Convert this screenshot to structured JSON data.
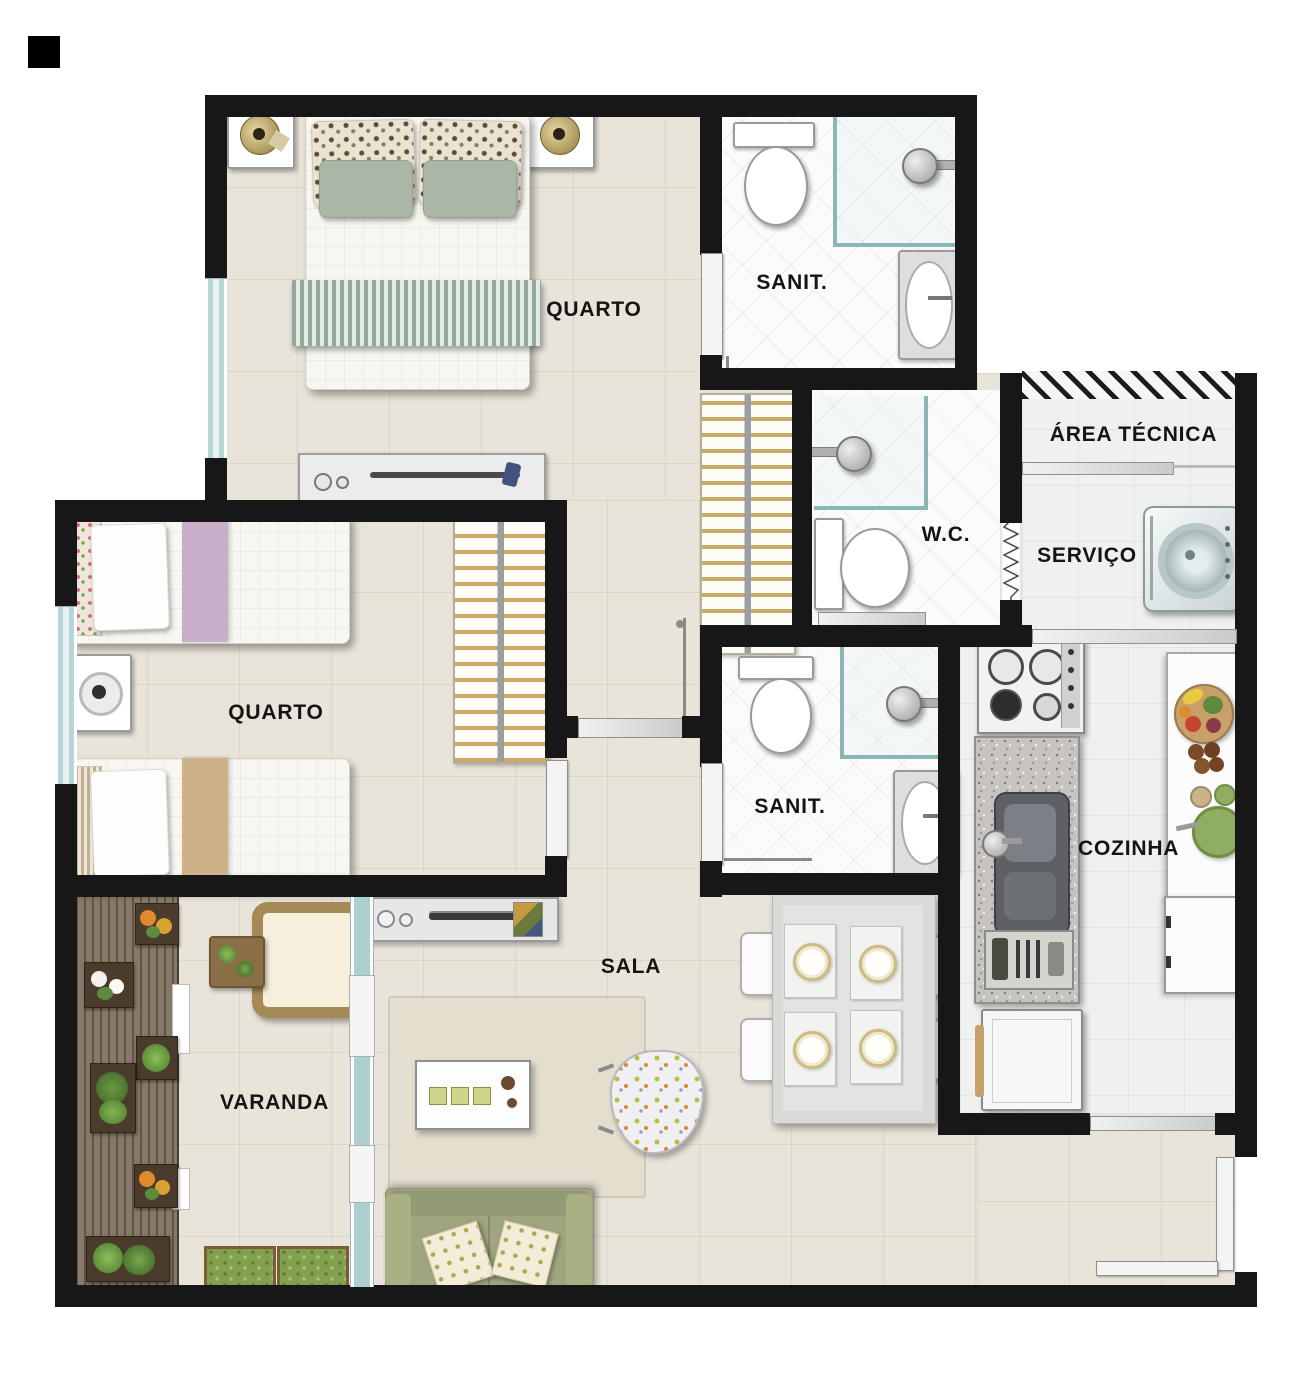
{
  "plan_title": "Apartment floor plan",
  "rooms": {
    "quarto1": {
      "label": "QUARTO"
    },
    "sanit1": {
      "label": "SANIT."
    },
    "area_tecnica": {
      "label": "ÁREA TÉCNICA"
    },
    "wc": {
      "label": "W.C."
    },
    "servico": {
      "label": "SERVIÇO"
    },
    "quarto2": {
      "label": "QUARTO"
    },
    "sanit2": {
      "label": "SANIT."
    },
    "cozinha": {
      "label": "COZINHA"
    },
    "sala": {
      "label": "SALA"
    },
    "varanda": {
      "label": "VARANDA"
    }
  },
  "palette": {
    "wall": "#171717",
    "floor_beige": "#e9e4da",
    "tile_white": "#fbfbfb",
    "kitchen_tile": "#eff0f0",
    "deck_brown": "#867969",
    "window_glass": "#b9d6d6",
    "door_gray": "#dcdcdc",
    "sofa_green": "#a0a580",
    "runner_sage": "#93a89d",
    "runner_lilac": "#c9aec9",
    "runner_tan": "#cdb289",
    "hanger_wood": "#cda768",
    "plant_green": "#5d8a3c",
    "flower_orange": "#e08a2f",
    "granite": "#c7c4c0"
  }
}
